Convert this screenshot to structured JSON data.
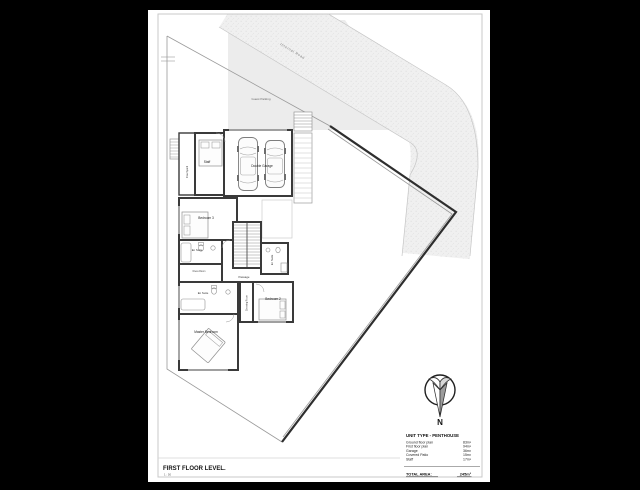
{
  "sheet": {
    "title": "FIRST FLOOR LEVEL.",
    "scale": "1 : 50"
  },
  "plan": {
    "labels": {
      "internal_road": "Internal Road",
      "guest_parking": "Guest Parking",
      "double_garage": "Double Garage",
      "staff": "Staff",
      "courtyard": "Courtyard",
      "bedroom_3": "Bedroom 3",
      "en_suite_bed3": "En Suite",
      "dress_room": "Dress Room",
      "passage": "Passage",
      "en_suite_right": "En Suite",
      "en_suite_master": "En Suite",
      "master_bedroom": "Master Bedroom",
      "dressing_room": "Dressing Room",
      "bedroom_2": "Bedroom 2"
    }
  },
  "compass": {
    "north_label": "N"
  },
  "areas": {
    "heading": "UNIT TYPE - PENTHOUSE",
    "rows": [
      {
        "label": "Ground floor plan",
        "value": "83m²"
      },
      {
        "label": "First floor plan",
        "value": "94m²"
      },
      {
        "label": "Garage",
        "value": "36m²"
      },
      {
        "label": "Covered Patio",
        "value": "15m²"
      },
      {
        "label": "Staff",
        "value": "17m²"
      }
    ],
    "total_label": "TOTAL AREA:",
    "total_value": "245m²"
  },
  "colors": {
    "canvas": "#000000",
    "paper": "#ffffff",
    "frame": "#c9c9c9",
    "wall": "#3a3a3a",
    "road_fill": "#f0f0f0",
    "parking_fill": "#ececec",
    "boundary_thick": "#2e2e2e",
    "boundary_thin": "#9a9a9a"
  }
}
